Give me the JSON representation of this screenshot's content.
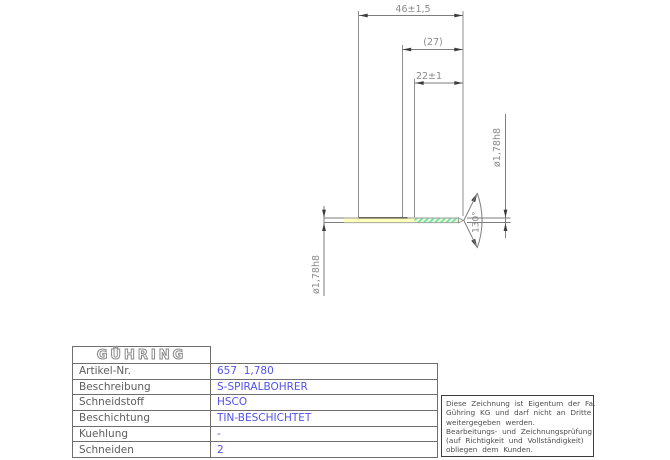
{
  "drawing": {
    "dims": {
      "overall_length": "46±1,5",
      "ref_length": "(27)",
      "flute_length": "22±1",
      "diameter_left": "ø1,78h8",
      "diameter_right": "ø1,78h8",
      "point_angle": "130°"
    },
    "colors": {
      "line": "#7d7d7d",
      "dim_text": "#8a8a8a",
      "arrow": "#3c3c3c",
      "body_fill": "#ffffbc",
      "flute_hatch": "#4fe3cf"
    }
  },
  "titleblock": {
    "logo": "GÜHRING",
    "value_color": "#5151ef",
    "rows": [
      {
        "label": "Artikel-Nr.",
        "value": "657  1,780"
      },
      {
        "label": "Beschreibung",
        "value": "S-SPIRALBOHRER"
      },
      {
        "label": "Schneidstoff",
        "value": "HSCO"
      },
      {
        "label": "Beschichtung",
        "value": "TIN-BESCHICHTET"
      },
      {
        "label": "Kuehlung",
        "value": "-"
      },
      {
        "label": "Schneiden",
        "value": "2"
      }
    ]
  },
  "notice": {
    "lines": [
      "Diese Zeichnung ist Eigentum der Fa.",
      "Gühring KG und darf nicht an Dritte",
      "weitergegeben werden.",
      "Bearbeitungs- und Zeichnungsprüfung",
      "(auf Richtigkeit und Vollständigkeit)",
      "obliegen dem Kunden."
    ]
  }
}
